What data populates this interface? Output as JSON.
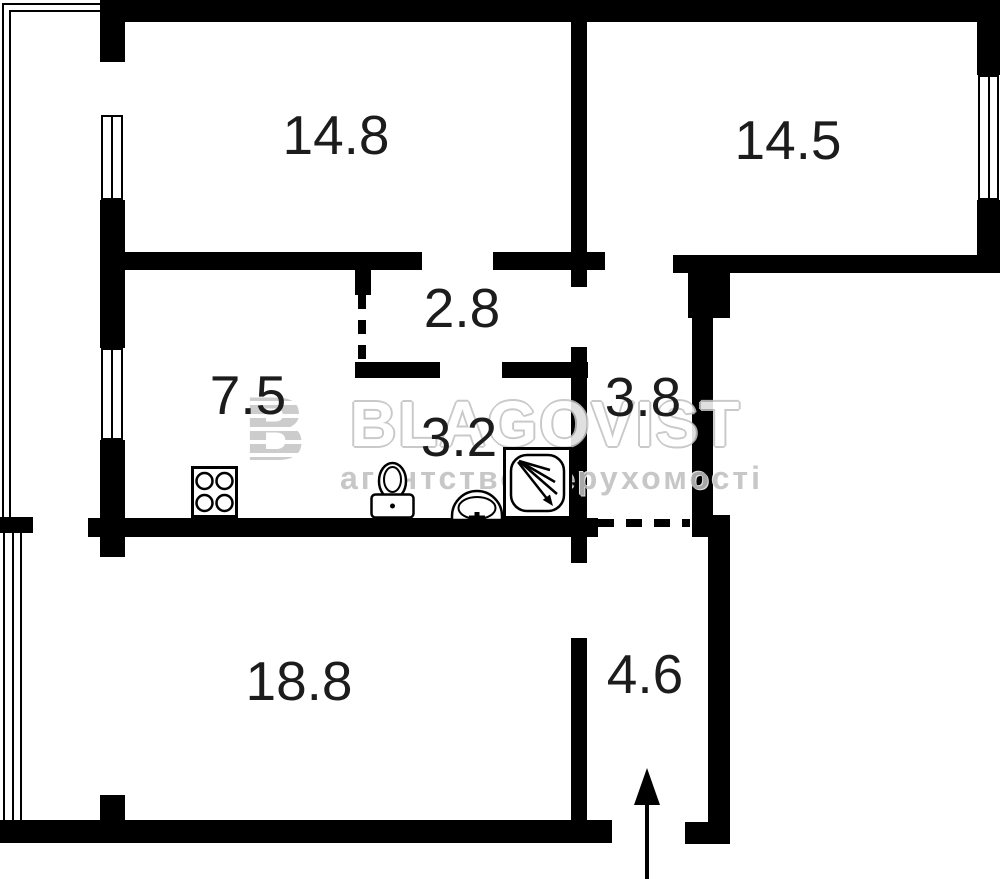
{
  "plan": {
    "title": "apartment floor plan",
    "rooms": {
      "room_14_8": {
        "area": "14.8"
      },
      "room_14_5": {
        "area": "14.5"
      },
      "hall_2_8": {
        "area": "2.8"
      },
      "kitchen_7_5": {
        "area": "7.5"
      },
      "bath_3_2": {
        "area": "3.2"
      },
      "corridor_3_8": {
        "area": "3.8"
      },
      "room_18_8": {
        "area": "18.8"
      },
      "entry_4_6": {
        "area": "4.6"
      }
    },
    "fixtures": {
      "stove": "stove-icon",
      "toilet": "toilet-icon",
      "sink": "sink-icon",
      "shower": "shower-icon",
      "entrance_arrow": "entrance-arrow-icon"
    }
  },
  "watermark": {
    "logo_letter": "B",
    "brand": "BLAGOVIST",
    "tagline": "агентство нерухомості"
  },
  "colors": {
    "wall": "#000000",
    "background": "#ffffff",
    "label_text": "#1c1c1c",
    "watermark_gray": "#c2c2c2"
  }
}
